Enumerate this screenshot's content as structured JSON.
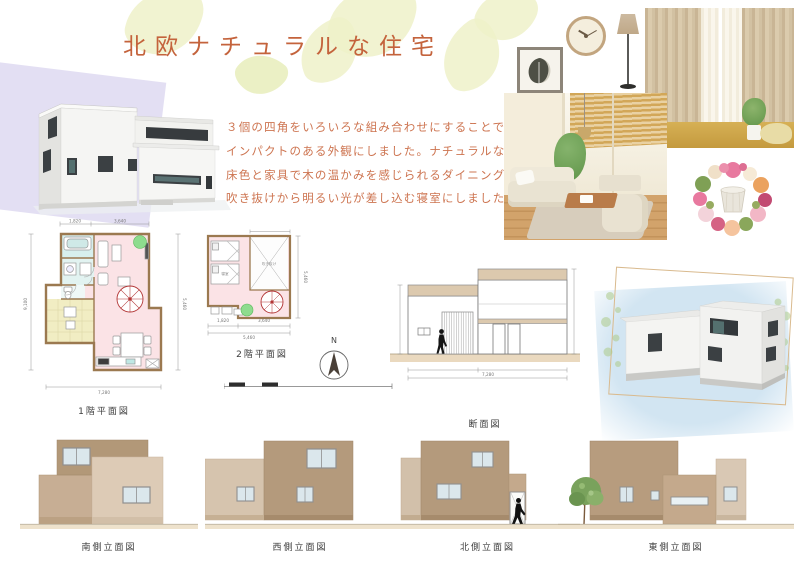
{
  "page": {
    "title": "北欧ナチュラルな住宅"
  },
  "description": {
    "lines": [
      "３個の四角をいろいろな組み合わせにすることで",
      "インパクトのある外観にしました。ナチュラルな",
      "床色と家具で木の温かみを感じられるダイニング、",
      "吹き抜けから明るい光が差し込む寝室にしました。"
    ]
  },
  "drawings": {
    "plan_1f": {
      "label": "1階平面図",
      "dims": {
        "top_left": "1,820",
        "top_right": "3,640",
        "bottom_total": "7,280",
        "left_total": "9,100",
        "right_total": "5,460"
      }
    },
    "plan_2f": {
      "label": "2階平面図",
      "rooms": {
        "bedroom": "寝室",
        "void": "吹き抜け"
      },
      "dims": {
        "bottom_left": "1,820",
        "bottom_right": "3,640",
        "bottom_total": "5,460",
        "right_total": "5,460"
      }
    },
    "compass": {
      "north_label": "N"
    },
    "section": {
      "label": "断面図",
      "dims": {
        "bottom_total": "7,280"
      }
    },
    "elevations": [
      {
        "label": "南側立面図"
      },
      {
        "label": "西側立面図"
      },
      {
        "label": "北側立面図"
      },
      {
        "label": "東側立面図"
      }
    ]
  },
  "photos": {
    "items": [
      "framed-leaf-art",
      "wall-clock",
      "floor-lamp",
      "beige-curtains",
      "living-room",
      "flower-wreath"
    ]
  },
  "colors": {
    "accent_text": "#c4633c",
    "tan_dark": "#b29878",
    "tan_mid": "#c4a98c",
    "tan_light": "#ddcbb6",
    "plan_wall": "#9b7950",
    "plan_floor_pink": "#fbe3e6",
    "plan_wet_blue": "#d7efed",
    "plan_tatami_yellow": "#f1edc3",
    "stair_red": "#b03030",
    "ground_beige": "#ecdfc8",
    "leaf_deco": "#eef1c9",
    "lavender_deco": "#dad4ef",
    "bluewash_deco": "#d2e5f2"
  }
}
